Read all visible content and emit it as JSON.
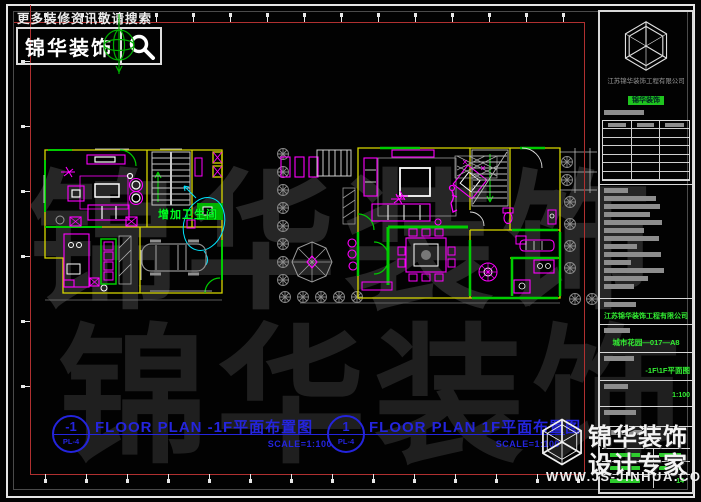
{
  "header": {
    "search_hint": "更多装修资讯敬请搜索",
    "brand": "锦华装饰"
  },
  "title_block": {
    "company": "江苏锦华装饰工程有限公司",
    "badge": "锦华装饰",
    "design_company": "江苏锦华装饰工程有限公司",
    "project_code": "城市花园—017—A8",
    "drawing_name": "-1F\\1F平面图",
    "scale": "1:100",
    "sheet_no": "14"
  },
  "plan_labels": [
    {
      "number": "-1",
      "ref": "PL-4",
      "title": "FLOOR PLAN -1F平面布置图",
      "scale": "SCALE=1:100"
    },
    {
      "number": "1",
      "ref": "PL-4",
      "title": "FLOOR PLAN 1F平面布置图",
      "scale": "SCALE=1:100"
    }
  ],
  "annotations": {
    "add_bathroom": "增加卫生间"
  },
  "watermark": {
    "big_text": "锦华装饰",
    "corner_title": "锦华装饰",
    "corner_subtitle": "设计专家",
    "corner_url": "WWW.JS-JINHUA.COM"
  },
  "colors": {
    "wall": "#d8d800",
    "furniture": "#ff00ff",
    "highlight": "#00cc00",
    "annotation_line": "#00ffff",
    "label_blue": "#2424dd",
    "frame_red": "#b03030"
  }
}
